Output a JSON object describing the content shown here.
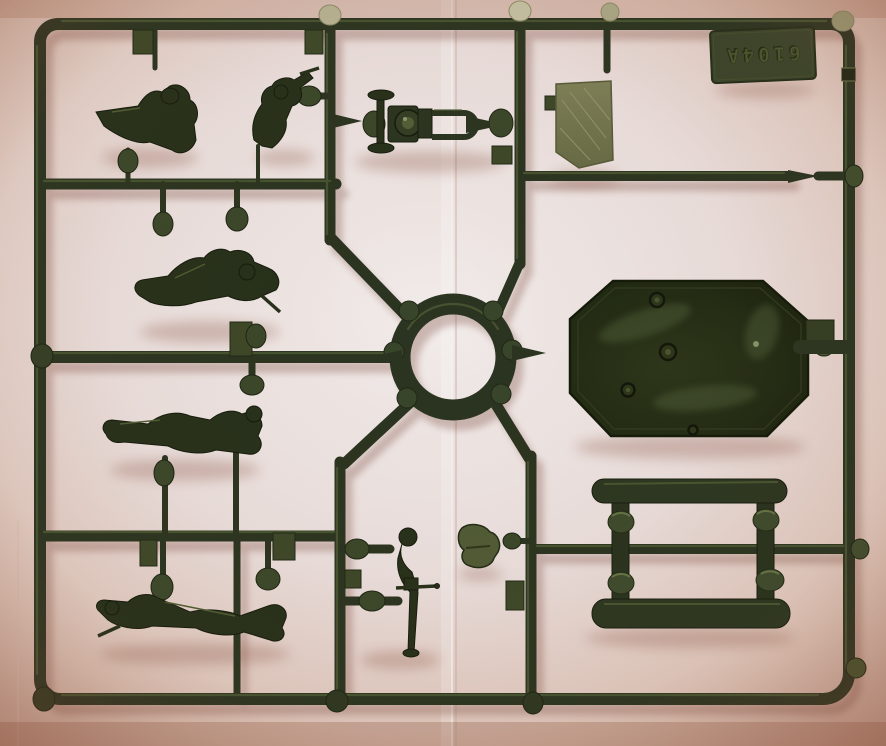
{
  "scene": {
    "description": "Photograph of a dark olive-green injection-moulded plastic model-kit sprue lying on creased white paper with warm pink vignetting",
    "object": "plastic model sprue with soldier figures and machine-gun parts",
    "orientation_note": "embossed code tag appears rotated 180 degrees (upside down)"
  },
  "sprue": {
    "code_label": "6104A",
    "parts": [
      {
        "name": "half-figure-gunner"
      },
      {
        "name": "kneeling-soldier"
      },
      {
        "name": "maxim-machine-gun-body"
      },
      {
        "name": "flat-panel"
      },
      {
        "name": "code-tag"
      },
      {
        "name": "gun-shield-plate"
      },
      {
        "name": "crawling-soldier-upper"
      },
      {
        "name": "reclining-soldier"
      },
      {
        "name": "crawling-soldier-lower"
      },
      {
        "name": "gun-carriage-with-trail"
      },
      {
        "name": "elevation-gear-part"
      },
      {
        "name": "sled-frame-rails"
      },
      {
        "name": "runner-ring-hub"
      }
    ],
    "colors": {
      "plastic": "#2a3420",
      "plastic_highlight": "#57673a",
      "gate_bump": "#3a4729",
      "bright_gate": "#b6b293",
      "panel_olive": "#73774e",
      "shield_gloss": "#1d2613"
    }
  },
  "background": {
    "paper_center": "#efe9e7",
    "paper_edge": "#cba394",
    "cast_shadow": "#7b4a3c",
    "fold_x": 452
  }
}
